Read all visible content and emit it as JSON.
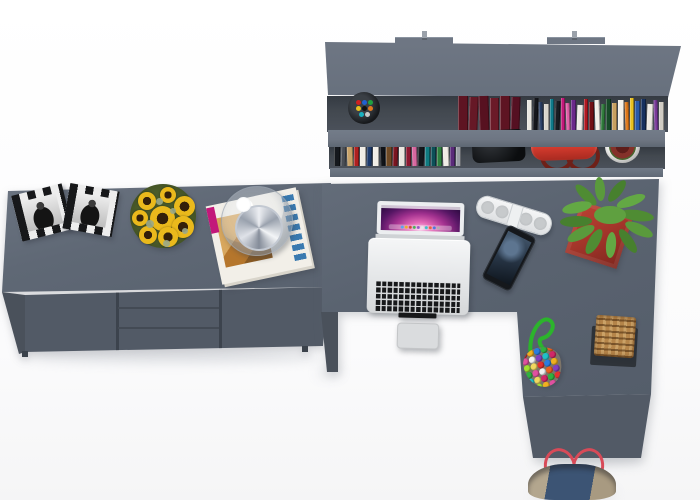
{
  "scene": {
    "label": "top-down-render-of-gray-home-office-furniture-set",
    "palette": {
      "shelf_top": "#6e7683",
      "side_top": "#5f6875",
      "desk_top": "#5a6370",
      "front": "#525a66",
      "recess": "#42484f",
      "leg": "#4a515b",
      "sun_yellow": "#eab91c",
      "sun_center": "#33200a",
      "sage": "#9aa98a",
      "key_dark": "#17181a",
      "wicker": "#b5854a",
      "denim": "#3c5474",
      "strap_red": "#d84a58",
      "rope_green": "#2cb42c"
    },
    "shelf": {
      "label": "wall-mounted-double-shelf-with-books",
      "mount_tab_count": 2,
      "shelf_count": 2,
      "maroon_books": [
        {
          "c": "#5e1422",
          "w": 10,
          "h": 34
        },
        {
          "c": "#661826",
          "w": 9,
          "h": 33
        },
        {
          "c": "#571120",
          "w": 10,
          "h": 34
        },
        {
          "c": "#6b1a28",
          "w": 9,
          "h": 32
        },
        {
          "c": "#5e1422",
          "w": 10,
          "h": 34
        },
        {
          "c": "#551022",
          "w": 9,
          "h": 33
        }
      ],
      "upper_books": [
        {
          "c": "#eae8e2",
          "w": 5,
          "h": 30
        },
        {
          "c": "#14161b",
          "w": 5,
          "h": 32
        },
        {
          "c": "#2a3f66",
          "w": 4,
          "h": 28
        },
        {
          "c": "#d9d5cd",
          "w": 5,
          "h": 26
        },
        {
          "c": "#0f7a8a",
          "w": 4,
          "h": 31
        },
        {
          "c": "#171c22",
          "w": 5,
          "h": 29
        },
        {
          "c": "#c2187a",
          "w": 4,
          "h": 32
        },
        {
          "c": "#e060a8",
          "w": 4,
          "h": 27
        },
        {
          "c": "#6a2a8a",
          "w": 5,
          "h": 30
        },
        {
          "c": "#efece6",
          "w": 6,
          "h": 25
        },
        {
          "c": "#b01820",
          "w": 4,
          "h": 31
        },
        {
          "c": "#701015",
          "w": 5,
          "h": 28
        },
        {
          "c": "#f2efe8",
          "w": 5,
          "h": 30
        },
        {
          "c": "#2e7a3a",
          "w": 4,
          "h": 26
        },
        {
          "c": "#184a28",
          "w": 5,
          "h": 31
        },
        {
          "c": "#c8a060",
          "w": 5,
          "h": 27
        },
        {
          "c": "#f4f1ea",
          "w": 6,
          "h": 30
        },
        {
          "c": "#e07818",
          "w": 4,
          "h": 28
        },
        {
          "c": "#e8c020",
          "w": 4,
          "h": 32
        },
        {
          "c": "#2858a8",
          "w": 5,
          "h": 29
        },
        {
          "c": "#16305e",
          "w": 5,
          "h": 31
        },
        {
          "c": "#ece9e2",
          "w": 6,
          "h": 26
        },
        {
          "c": "#7a3a9a",
          "w": 4,
          "h": 30
        },
        {
          "c": "#d0ccc4",
          "w": 5,
          "h": 28
        }
      ],
      "lower_books": [
        {
          "c": "#15181d",
          "w": 6,
          "h": 25
        },
        {
          "c": "#4a4e55",
          "w": 5,
          "h": 22
        },
        {
          "c": "#c8a268",
          "w": 6,
          "h": 24
        },
        {
          "c": "#b02020",
          "w": 5,
          "h": 26
        },
        {
          "c": "#efece5",
          "w": 6,
          "h": 21
        },
        {
          "c": "#1d3a6b",
          "w": 5,
          "h": 25
        },
        {
          "c": "#f1eee7",
          "w": 6,
          "h": 23
        },
        {
          "c": "#101318",
          "w": 5,
          "h": 26
        },
        {
          "c": "#6e4a26",
          "w": 6,
          "h": 22
        },
        {
          "c": "#7a1420",
          "w": 5,
          "h": 25
        },
        {
          "c": "#e9e6df",
          "w": 6,
          "h": 20
        },
        {
          "c": "#8c1830",
          "w": 5,
          "h": 24
        },
        {
          "c": "#d868a0",
          "w": 5,
          "h": 26
        },
        {
          "c": "#14171c",
          "w": 6,
          "h": 23
        },
        {
          "c": "#107a80",
          "w": 5,
          "h": 25
        },
        {
          "c": "#0c5058",
          "w": 5,
          "h": 22
        },
        {
          "c": "#2e8040",
          "w": 5,
          "h": 24
        },
        {
          "c": "#f0ede6",
          "w": 6,
          "h": 21
        },
        {
          "c": "#5a2a7a",
          "w": 5,
          "h": 25
        },
        {
          "c": "#9a9ea6",
          "w": 5,
          "h": 22
        }
      ],
      "pen_colors": [
        {
          "c": "#d02020"
        },
        {
          "c": "#2060d0"
        },
        {
          "c": "#20a040"
        },
        {
          "c": "#e8c020"
        },
        {
          "c": "#111111"
        },
        {
          "c": "#e07820"
        },
        {
          "c": "#18b0c0"
        },
        {
          "c": "#c8c8c8"
        }
      ],
      "red_handbag_color": "#d13a2d",
      "black_case_color": "#0b0d0f",
      "potted_plant_pot_color": "#f1f1ef"
    },
    "sideboard": {
      "label": "low-sideboard-cabinet",
      "door_count": 2,
      "drawer_count": 3,
      "photo_frame_count": 2,
      "flowers": [
        {
          "x": 8,
          "y": 8,
          "s": 18
        },
        {
          "x": 30,
          "y": 3,
          "s": 16
        },
        {
          "x": 44,
          "y": 12,
          "s": 21
        },
        {
          "x": 2,
          "y": 26,
          "s": 16
        },
        {
          "x": 20,
          "y": 22,
          "s": 25
        },
        {
          "x": 42,
          "y": 32,
          "s": 22
        },
        {
          "x": 9,
          "y": 42,
          "s": 18
        },
        {
          "x": 28,
          "y": 43,
          "s": 20
        }
      ],
      "sprigs": [
        {
          "x": 26,
          "y": 14,
          "s": 7
        },
        {
          "x": 16,
          "y": 36,
          "s": 8
        },
        {
          "x": 40,
          "y": 24,
          "s": 6
        },
        {
          "x": 33,
          "y": 56,
          "s": 7
        },
        {
          "x": 52,
          "y": 44,
          "s": 6
        }
      ],
      "magazine_accent_color": "#3a7ab0",
      "dome_lamp_glass": "rgba(233,238,243,0.4)"
    },
    "desk": {
      "label": "l-shaped-corner-desk",
      "laptop": {
        "label": "open-macbook-top-view",
        "dock_dots": [
          {
            "c": "#58a6f0"
          },
          {
            "c": "#e8b028"
          },
          {
            "c": "#d04838"
          },
          {
            "c": "#48b058"
          },
          {
            "c": "#9858c8"
          },
          {
            "c": "#e8e8e8"
          },
          {
            "c": "#38c0c8"
          },
          {
            "c": "#e86838"
          },
          {
            "c": "#4878e0"
          },
          {
            "c": "#b0b0b0"
          }
        ]
      },
      "speaker_grille_count": 4,
      "plant_leaves": [
        {
          "x": 62,
          "y": 28,
          "w": 34,
          "h": 11,
          "r": 8,
          "c": "#4f8c33"
        },
        {
          "x": 58,
          "y": 14,
          "w": 30,
          "h": 10,
          "r": -20,
          "c": "#63a844"
        },
        {
          "x": 46,
          "y": 4,
          "w": 26,
          "h": 10,
          "r": -52,
          "c": "#47802e"
        },
        {
          "x": 30,
          "y": 2,
          "w": 24,
          "h": 10,
          "r": -95,
          "c": "#5a9a3c"
        },
        {
          "x": 14,
          "y": 8,
          "w": 28,
          "h": 10,
          "r": -135,
          "c": "#4f8c33"
        },
        {
          "x": 4,
          "y": 20,
          "w": 30,
          "h": 11,
          "r": 168,
          "c": "#63a844"
        },
        {
          "x": 2,
          "y": 34,
          "w": 32,
          "h": 11,
          "r": 178,
          "c": "#47802e"
        },
        {
          "x": 8,
          "y": 46,
          "w": 30,
          "h": 11,
          "r": 152,
          "c": "#5a9a3c"
        },
        {
          "x": 22,
          "y": 54,
          "w": 28,
          "h": 11,
          "r": 120,
          "c": "#4f8c33"
        },
        {
          "x": 40,
          "y": 58,
          "w": 26,
          "h": 10,
          "r": 95,
          "c": "#63a844"
        },
        {
          "x": 56,
          "y": 54,
          "w": 28,
          "h": 10,
          "r": 55,
          "c": "#47802e"
        },
        {
          "x": 66,
          "y": 42,
          "w": 30,
          "h": 11,
          "r": 25,
          "c": "#5a9a3c"
        },
        {
          "x": 36,
          "y": 24,
          "w": 32,
          "h": 18,
          "r": 0,
          "c": "#5fa040"
        }
      ],
      "beads": [
        {
          "c": "#e23030"
        },
        {
          "c": "#f0b020"
        },
        {
          "c": "#2a7de0"
        },
        {
          "c": "#30b040"
        },
        {
          "c": "#e86020"
        },
        {
          "c": "#e050a0"
        },
        {
          "c": "#f0f0f0"
        },
        {
          "c": "#8040c0"
        },
        {
          "c": "#20c0c8"
        },
        {
          "c": "#d02868"
        },
        {
          "c": "#a0e030"
        },
        {
          "c": "#f0d860"
        },
        {
          "c": "#e23030"
        },
        {
          "c": "#2a7de0"
        },
        {
          "c": "#f0b020"
        },
        {
          "c": "#30b040"
        },
        {
          "c": "#e050a0"
        },
        {
          "c": "#f0f0f0"
        },
        {
          "c": "#e86020"
        },
        {
          "c": "#8040c0"
        },
        {
          "c": "#20c0c8"
        },
        {
          "c": "#f0d860"
        },
        {
          "c": "#d02868"
        },
        {
          "c": "#30b040"
        },
        {
          "c": "#e23030"
        },
        {
          "c": "#2a7de0"
        },
        {
          "c": "#a0e030"
        },
        {
          "c": "#f0b020"
        },
        {
          "c": "#e050a0"
        },
        {
          "c": "#f0f0f0"
        }
      ],
      "wicker_stool_color": "#b5854a",
      "tote_bag_colors": {
        "canvas": "#b3a68e",
        "denim": "#3c5474",
        "straps": "#d84a58"
      }
    }
  }
}
